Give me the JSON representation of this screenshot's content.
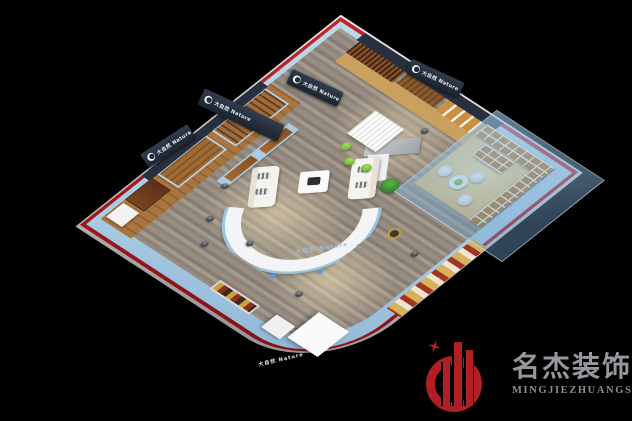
{
  "canvas": {
    "width": 632,
    "height": 421,
    "background": "#000000"
  },
  "scene": {
    "palette": {
      "outer_band_red": "#a5161d",
      "wall_blue": "#a9cbe4",
      "fascia_navy": "#27303e",
      "floor_grey": "#968c81",
      "wood_warm": "#a9743d",
      "accent_green": "#7fc241",
      "warm_light": "#f7dfa0"
    },
    "brand_sign": {
      "icon": "nature-circle-logo",
      "label": "大自然 Nature"
    },
    "front_band_mark": "大自然 Nature",
    "desk_mark": "大自然 Nature"
  },
  "watermark": {
    "icon": "building-circle-star-emblem",
    "company_cn": "名杰装饰",
    "company_en": "MINGJIEZHUANGSHI",
    "emblem_color": "#b01f24",
    "text_color": "#97979d"
  }
}
